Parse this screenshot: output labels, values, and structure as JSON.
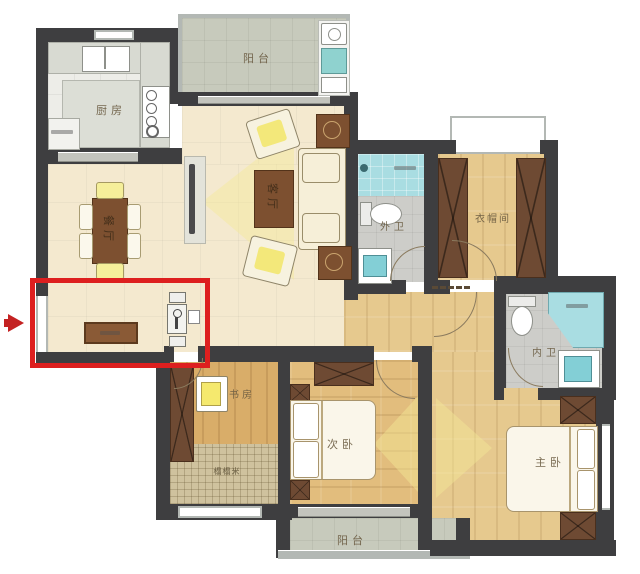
{
  "figure": {
    "type": "floor-plan",
    "rooms": {
      "kitchen": "厨房",
      "balcony_top": "阳台",
      "dining": "餐厅",
      "living": "客厅",
      "guest_bath": "外卫",
      "cloakroom": "衣帽间",
      "master_bath": "内卫",
      "study": "书房",
      "tatami": "榻榻米",
      "second_bedroom": "次卧",
      "master_bedroom": "主卧",
      "balcony_bottom": "阳台"
    },
    "highlight": {
      "color": "#dd1f1f",
      "note_icon": "red-arrow-pointing-to-entry"
    },
    "colors": {
      "wall": "#3e3e40",
      "floor_cream": "#f4e9cf",
      "floor_wood": "#e6c98e",
      "bath_blue": "#a9dde2",
      "balcony_gray": "#c7cabc",
      "furniture_brown": "#7d5030",
      "wardrobe_brown": "#6e4a33"
    }
  }
}
